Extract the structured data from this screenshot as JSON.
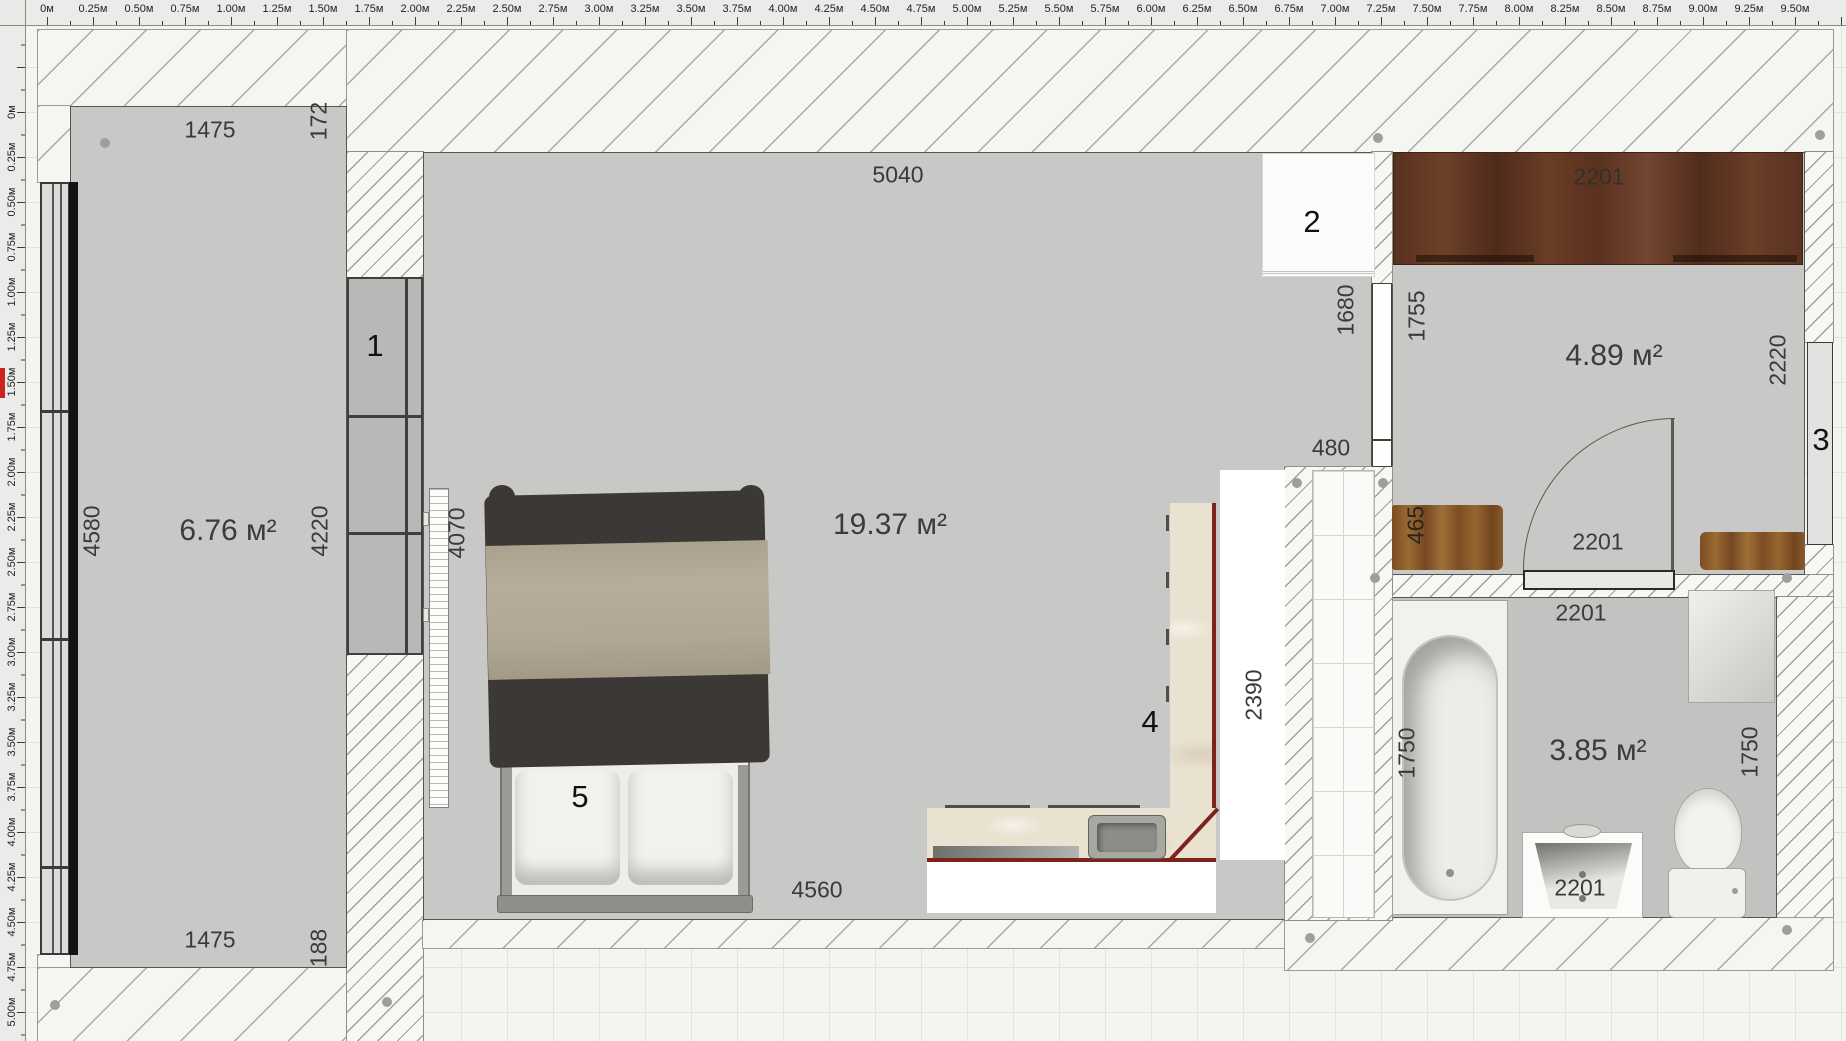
{
  "app_title": "floor-plan-editor",
  "rulers": {
    "top": {
      "labels": [
        "0м",
        "0.25м",
        "0.50м",
        "0.75м",
        "1.00м",
        "1.25м",
        "1.50м",
        "1.75м",
        "2.00м",
        "2.25м",
        "2.50м",
        "2.75м",
        "3.00м",
        "3.25м",
        "3.50м",
        "3.75м",
        "4.00м",
        "4.25м",
        "4.50м",
        "4.75м",
        "5.00м",
        "5.25м",
        "5.50м",
        "5.75м",
        "6.00м",
        "6.25м",
        "6.50м",
        "6.75м",
        "7.00м",
        "7.25м",
        "7.50м",
        "7.75м",
        "8.00м",
        "8.25м",
        "8.50м",
        "8.75м",
        "9.00м",
        "9.25м",
        "9.50м"
      ]
    },
    "left": {
      "labels": [
        "0м",
        "0.25м",
        "0.50м",
        "0.75м",
        "1.00м",
        "1.25м",
        "1.50м",
        "1.75м",
        "2.00м",
        "2.25м",
        "2.50м",
        "2.75м",
        "3.00м",
        "3.25м",
        "3.50м",
        "3.75м",
        "4.00м",
        "4.25м",
        "4.50м",
        "4.75м",
        "5.00м"
      ]
    }
  },
  "rooms": {
    "balcony": {
      "area_label": "6.76 м²"
    },
    "living": {
      "area_label": "19.37 м²"
    },
    "hallway": {
      "area_label": "4.89 м²"
    },
    "bathroom": {
      "area_label": "3.85 м²"
    }
  },
  "dims": {
    "balcony_top": "1475",
    "balcony_top_side": "172",
    "balcony_window": "4580",
    "balcony_inner": "4220",
    "balcony_bottom": "1475",
    "balcony_bottom_side": "188",
    "living_top": "5040",
    "radiator": "4070",
    "living_bottom": "4560",
    "door_opening": "1680",
    "niche": "480",
    "kitchen_counter": "2390",
    "hall_wardrobe": "2201",
    "hall_left": "1755",
    "hall_window": "2220",
    "bench": "465",
    "hall_door": "2201",
    "bath_door": "2201",
    "bathtub": "1750",
    "bath_side": "1750",
    "sink": "2201"
  },
  "markers": {
    "wardrobe": "1",
    "fridge": "2",
    "window": "3",
    "kitchen": "4",
    "bed": "5"
  },
  "colors": {
    "counter_edge": "#7c231b",
    "wood_dark": "#5e3424",
    "wood_light": "#8a5a2b",
    "floor_gray": "#c8c8c6",
    "hatch_line": "#a0a09c",
    "ruler_cursor": "#cc2222"
  }
}
